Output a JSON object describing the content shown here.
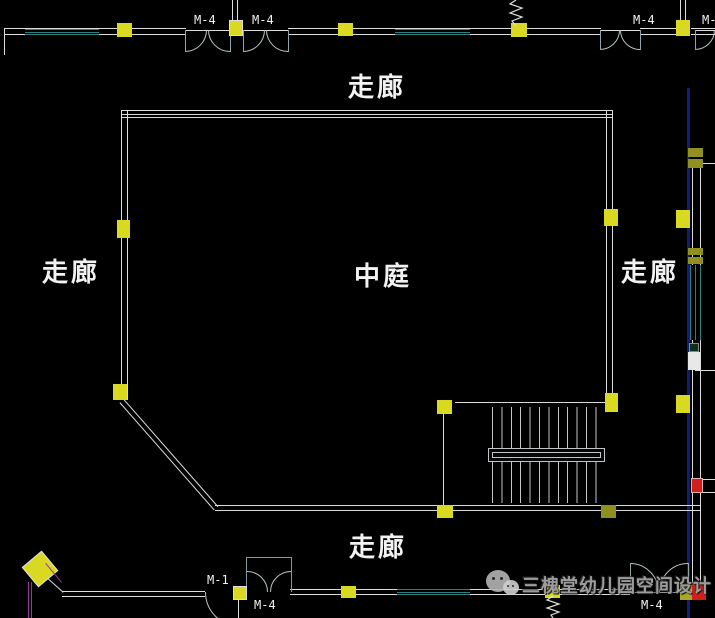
{
  "title": "中庭平面图",
  "labels": {
    "corridor_top": "走廊",
    "corridor_left": "走廊",
    "corridor_right": "走廊",
    "corridor_bottom": "走廊",
    "atrium": "中庭"
  },
  "door_tags": {
    "top_left_1": "M-4",
    "top_left_2": "M-4",
    "top_right": "M-4",
    "top_far_right": "M-4",
    "bottom_m1": "M-1",
    "bottom_center": "M-4",
    "bottom_right": "M-4"
  },
  "watermark": {
    "icon": "wechat-icon",
    "text": "三槐堂幼儿园空间设计"
  },
  "colors": {
    "background": "#000000",
    "wall": "#dcdcdc",
    "window_teal": "#2e8080",
    "column_yellow": "#d9d922",
    "column_dim": "#8f8f22",
    "door_arc": "#b9c4c4",
    "highlight_blue": "#0d1f7e",
    "alert_red": "#cf1f1f",
    "magenta": "#993399",
    "label_white": "#f2f2f2",
    "watermark_gray": "#9c9c9c"
  }
}
